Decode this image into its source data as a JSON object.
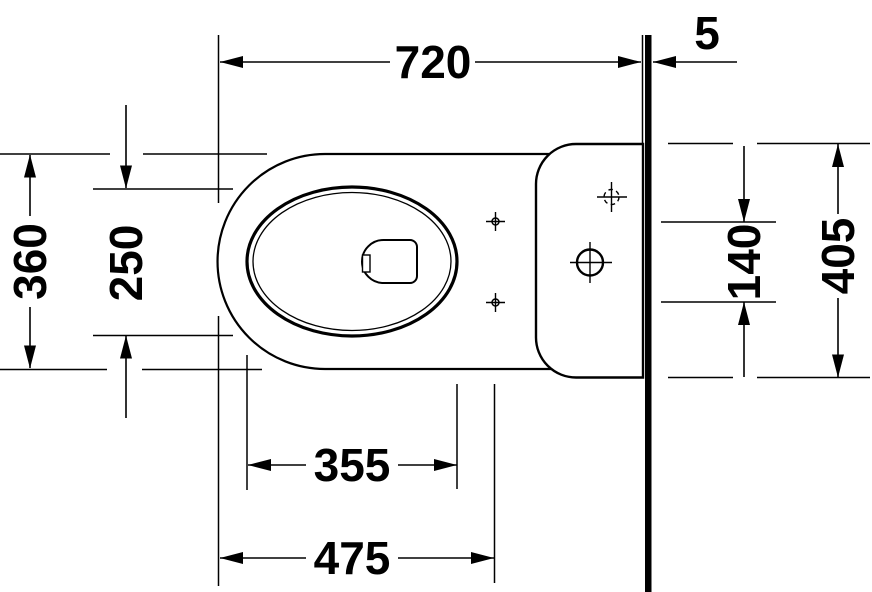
{
  "drawing": {
    "background_color": "#ffffff",
    "line_color": "#000000",
    "dimensions": {
      "front_to_wall": "720",
      "wall_thickness": "5",
      "body_width": "360",
      "seat_opening_width": "250",
      "fixing_holes_spacing": "140",
      "tank_width": "405",
      "seat_opening_length": "355",
      "front_to_fixing_holes": "475"
    }
  }
}
